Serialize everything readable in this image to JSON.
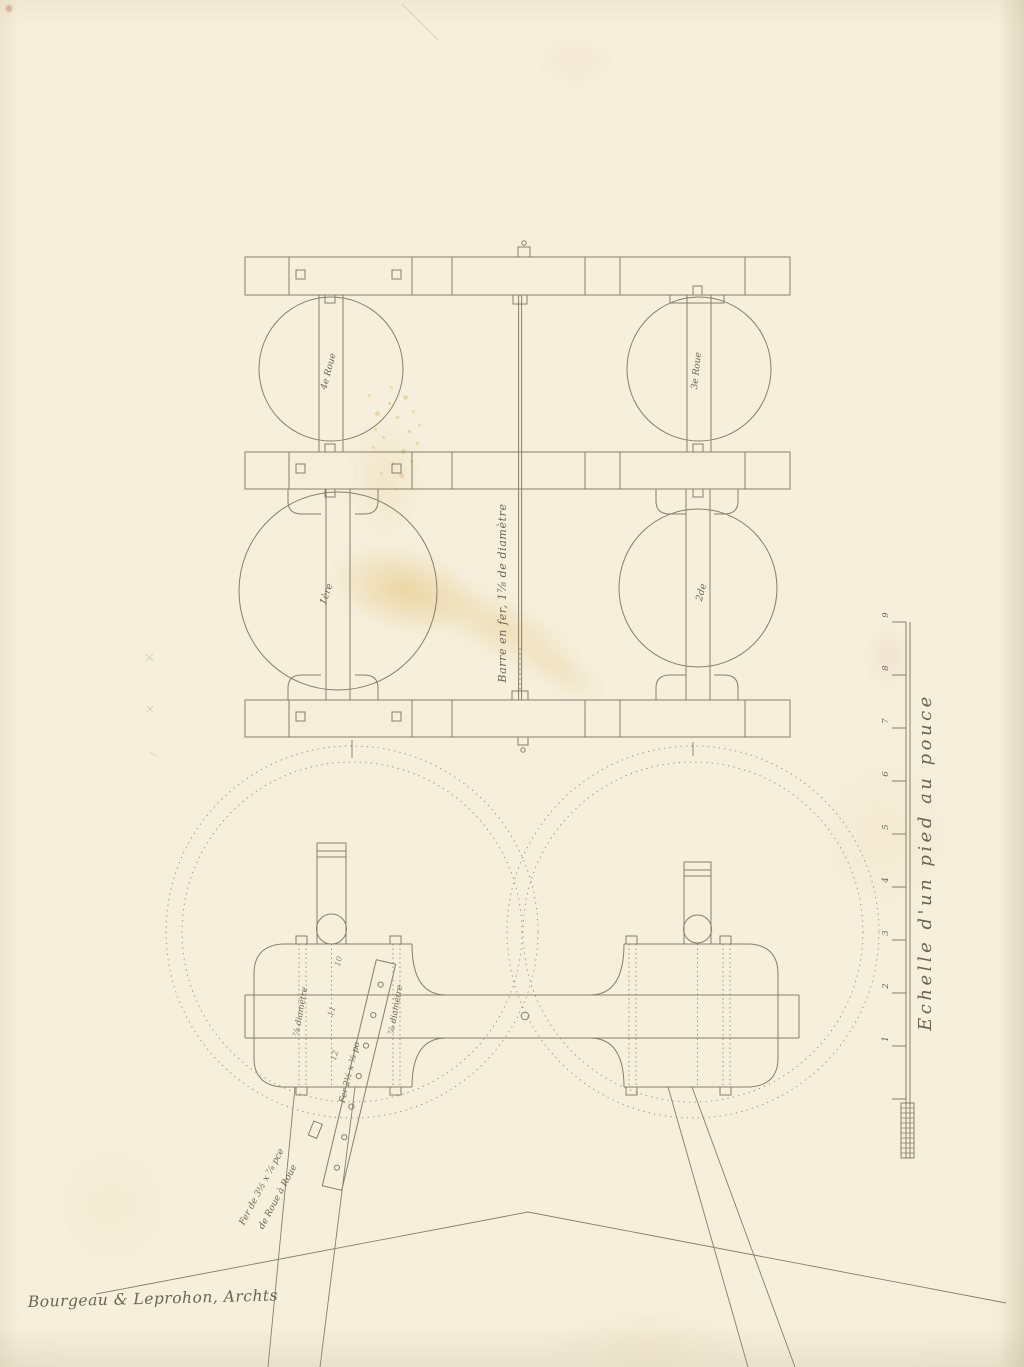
{
  "annotations": {
    "signature": "Bourgeau & Leprohon, Archts",
    "scale_label": "Echelle d'un pied au pouce",
    "shaft_label": "Barre en fer, 1⅞ de diamètre",
    "wheel_labels": {
      "upper_left": "4e Roue",
      "upper_right": "3e Roue",
      "lower_left": "1ère",
      "lower_right": "2de"
    },
    "bolt_label_left": "⅞ diamètre",
    "bolt_label_right": "⅞ diamètre",
    "strap_label": "Fer 2½ x ⅜ po",
    "leg_note_line1": "Fer de 3½ x ⅞ pce",
    "leg_note_line2": "de Roue à Roue",
    "pencil_marks": [
      "10",
      "11",
      "12"
    ],
    "ruler_numbers": [
      "9",
      "8",
      "7",
      "6",
      "5",
      "4",
      "3",
      "2",
      "1"
    ]
  },
  "colors": {
    "paper": "#f6efdc",
    "ink": "#877f6d",
    "stain": "#dfb861"
  }
}
